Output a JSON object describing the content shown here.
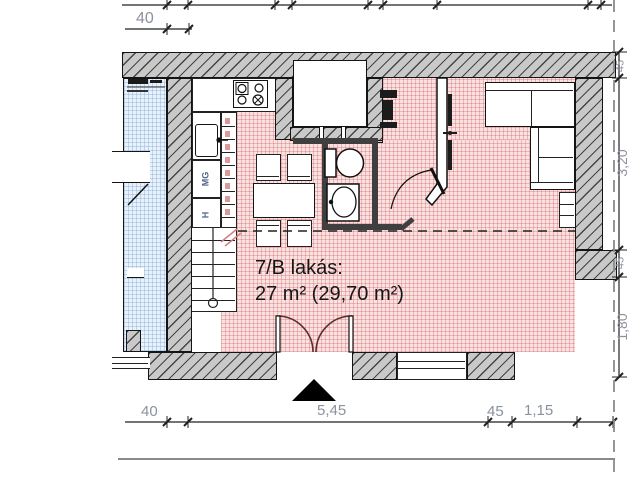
{
  "plan": {
    "apartment_label": "7/B lakás:",
    "area_label": "27 m² (29,70 m²)"
  },
  "kitchen": {
    "dishwasher_label": "MG",
    "fridge_label": "H"
  },
  "dimensions": {
    "wall_top_left": "40",
    "bottom_40": "40",
    "bottom_545": "5,45",
    "bottom_45": "45",
    "bottom_115": "1,15",
    "right_45_top": "45",
    "right_320": "3,20",
    "right_45_mid": "45",
    "right_180": "1,80"
  },
  "colors": {
    "apartment_floor_tint": "#f9e2e2",
    "neighbor_floor_tint": "#e9f2fb",
    "wall_fill": "#c9c9c9",
    "dimension_text": "#8a929e"
  }
}
